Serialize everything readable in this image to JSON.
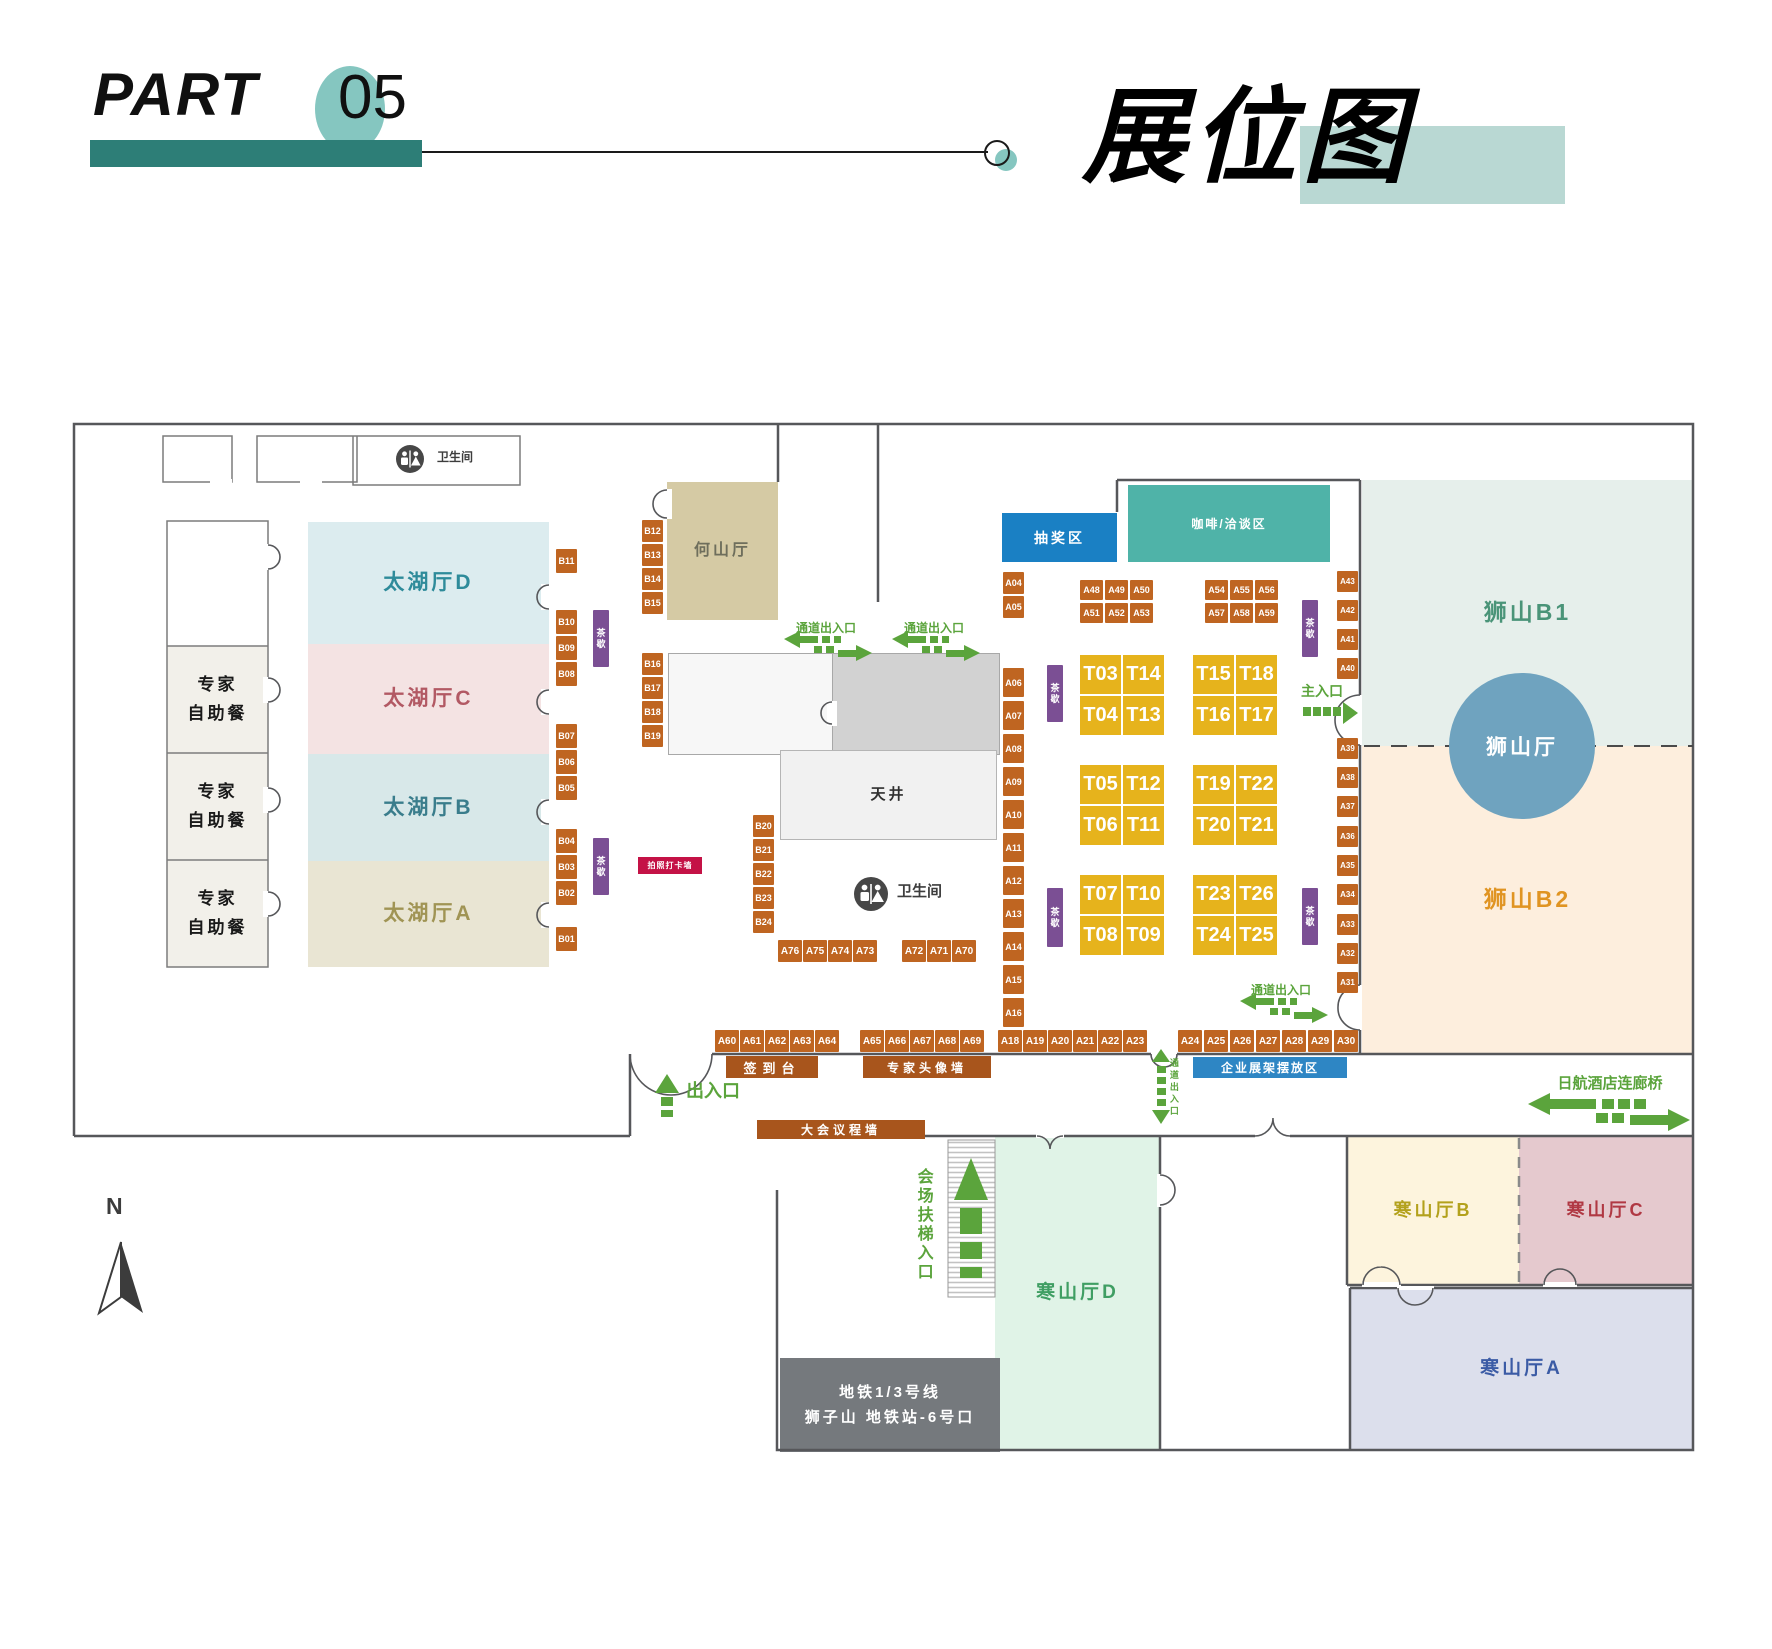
{
  "header": {
    "part": "PART",
    "number": "05",
    "title": "展位图"
  },
  "plan": {
    "tea_label": "茶歇",
    "rooms": [
      {
        "name": "room-top-1",
        "x": 163,
        "y": 436,
        "w": 69,
        "h": 46,
        "bg": "#ffffff"
      },
      {
        "name": "room-top-2",
        "x": 257,
        "y": 436,
        "w": 100,
        "h": 46,
        "bg": "#ffffff"
      },
      {
        "name": "room-restroom-top",
        "x": 353,
        "y": 436,
        "w": 167,
        "h": 49,
        "bg": "#ffffff"
      },
      {
        "name": "room-empty-left",
        "x": 167,
        "y": 521,
        "w": 101,
        "h": 125,
        "bg": "#ffffff"
      },
      {
        "name": "buffet-room-1",
        "x": 167,
        "y": 646,
        "w": 101,
        "h": 107,
        "bg": "#f2f0ea",
        "label": "专家",
        "label2": "自助餐",
        "fg": "#1a1a1a",
        "fs": 17
      },
      {
        "name": "buffet-room-2",
        "x": 167,
        "y": 753,
        "w": 101,
        "h": 107,
        "bg": "#f2f0ea",
        "label": "专家",
        "label2": "自助餐",
        "fg": "#1a1a1a",
        "fs": 17
      },
      {
        "name": "buffet-room-3",
        "x": 167,
        "y": 860,
        "w": 101,
        "h": 107,
        "bg": "#f2f0ea",
        "label": "专家",
        "label2": "自助餐",
        "fg": "#1a1a1a",
        "fs": 17
      },
      {
        "name": "hall-taihu-d",
        "x": 308,
        "y": 522,
        "w": 241,
        "h": 122,
        "bg": "#dcecef",
        "label": "太湖厅D",
        "fg": "#2e8b9a",
        "fs": 21
      },
      {
        "name": "hall-taihu-c",
        "x": 308,
        "y": 644,
        "w": 241,
        "h": 110,
        "bg": "#f4e3e3",
        "label": "太湖厅C",
        "fg": "#b25964",
        "fs": 21
      },
      {
        "name": "hall-taihu-b",
        "x": 308,
        "y": 754,
        "w": 241,
        "h": 107,
        "bg": "#d8e8e9",
        "label": "太湖厅B",
        "fg": "#3a7d8c",
        "fs": 21
      },
      {
        "name": "hall-taihu-a",
        "x": 308,
        "y": 861,
        "w": 241,
        "h": 106,
        "bg": "#e9e5d3",
        "label": "太湖厅A",
        "fg": "#a09454",
        "fs": 21
      },
      {
        "name": "hall-heshan",
        "x": 667,
        "y": 482,
        "w": 111,
        "h": 138,
        "bg": "#d5caa4",
        "label": "何山厅",
        "fg": "#6e6e5c",
        "fs": 16
      },
      {
        "name": "room-center-light",
        "x": 668,
        "y": 653,
        "w": 164,
        "h": 100,
        "bg": "#f7f7f7",
        "bd": "#a8a8a8"
      },
      {
        "name": "room-center-gray",
        "x": 832,
        "y": 653,
        "w": 166,
        "h": 100,
        "bg": "#d2d2d2",
        "bd": "#a8a8a8"
      },
      {
        "name": "courtyard-tianjing",
        "x": 780,
        "y": 750,
        "w": 215,
        "h": 88,
        "bg": "#f1f1f1",
        "bd": "#b5b5b5",
        "label": "天井",
        "fg": "#2f2f2f",
        "fs": 15
      },
      {
        "name": "hall-shishan-b1",
        "x": 1362,
        "y": 480,
        "w": 331,
        "h": 266,
        "bg": "#e6efeb",
        "label": "狮山B1",
        "fg": "#4a9478",
        "fs": 23
      },
      {
        "name": "hall-shishan-b2",
        "x": 1362,
        "y": 746,
        "w": 331,
        "h": 308,
        "bg": "#fdeedd",
        "label": "狮山B2",
        "fg": "#e09422",
        "fs": 23
      },
      {
        "name": "hall-hanshan-d",
        "x": 995,
        "y": 1136,
        "w": 165,
        "h": 314,
        "bg": "#e0f3e7",
        "label": "寒山厅D",
        "fg": "#3f9e63",
        "fs": 19
      },
      {
        "name": "hall-hanshan-b",
        "x": 1347,
        "y": 1136,
        "w": 172,
        "h": 149,
        "bg": "#fdf4dd",
        "label": "寒山厅B",
        "fg": "#b3a11c",
        "fs": 18
      },
      {
        "name": "hall-hanshan-c",
        "x": 1519,
        "y": 1136,
        "w": 174,
        "h": 149,
        "bg": "#e5c9ce",
        "label": "寒山厅C",
        "fg": "#b03843",
        "fs": 18
      },
      {
        "name": "hall-hanshan-a",
        "x": 1350,
        "y": 1288,
        "w": 343,
        "h": 162,
        "bg": "#dcdfec",
        "label": "寒山厅A",
        "fg": "#3b5ba5",
        "fs": 19
      },
      {
        "name": "metro-block",
        "x": 780,
        "y": 1358,
        "w": 220,
        "h": 94,
        "bg": "#75797d",
        "label": "地铁1/3号线",
        "label2": "狮子山 地铁站-6号口",
        "fg": "#ffffff",
        "fs": 15
      }
    ],
    "circle": {
      "name": "hall-shishan-ting",
      "x": 1449,
      "y": 673,
      "d": 146,
      "bg": "#6fa3bf",
      "label": "狮山厅",
      "fg": "#ffffff",
      "fs": 21
    },
    "zones": [
      {
        "name": "zone-lottery",
        "label": "抽奖区",
        "x": 1002,
        "y": 513,
        "w": 115,
        "h": 49,
        "bg": "#1a80c4",
        "fs": 14,
        "ls": 3
      },
      {
        "name": "zone-coffee",
        "label": "咖啡/洽谈区",
        "x": 1128,
        "y": 485,
        "w": 202,
        "h": 77,
        "bg": "#4fb3a8",
        "fs": 12,
        "ls": 2
      },
      {
        "name": "bar-signin",
        "label": "签到台",
        "x": 726,
        "y": 1056,
        "w": 92,
        "h": 22,
        "bg": "#a8551c",
        "fs": 13,
        "ls": 6
      },
      {
        "name": "bar-expert-wall",
        "label": "专家头像墙",
        "x": 863,
        "y": 1056,
        "w": 128,
        "h": 22,
        "bg": "#a8551c",
        "fs": 12,
        "ls": 4
      },
      {
        "name": "bar-display-rack",
        "label": "企业展架摆放区",
        "x": 1193,
        "y": 1057,
        "w": 154,
        "h": 21,
        "bg": "#2e86c4",
        "fs": 12,
        "ls": 2
      },
      {
        "name": "bar-agenda-wall",
        "label": "大会议程墙",
        "x": 757,
        "y": 1120,
        "w": 168,
        "h": 19,
        "bg": "#a8551c",
        "fs": 12,
        "ls": 4
      },
      {
        "name": "tag-photo-wall",
        "label": "拍照打卡墙",
        "x": 638,
        "y": 857,
        "w": 64,
        "h": 17,
        "bg": "#c41246",
        "fs": 8,
        "ls": 1
      }
    ],
    "tea_tags": [
      {
        "x": 593,
        "y": 610,
        "h": 57
      },
      {
        "x": 593,
        "y": 838,
        "h": 57
      },
      {
        "x": 1047,
        "y": 665,
        "h": 57
      },
      {
        "x": 1047,
        "y": 888,
        "h": 59
      },
      {
        "x": 1302,
        "y": 600,
        "h": 57
      },
      {
        "x": 1302,
        "y": 888,
        "h": 57
      }
    ],
    "booth_cols": [
      {
        "x": 556,
        "w": 21,
        "h": 24,
        "fs": 9,
        "items": [
          [
            "B11",
            549
          ],
          [
            "B10",
            610
          ],
          [
            "B09",
            636
          ],
          [
            "B08",
            662
          ],
          [
            "B07",
            724
          ],
          [
            "B06",
            750
          ],
          [
            "B05",
            776
          ],
          [
            "B04",
            829
          ],
          [
            "B03",
            855
          ],
          [
            "B02",
            881
          ],
          [
            "B01",
            927
          ]
        ]
      },
      {
        "x": 642,
        "w": 21,
        "h": 22,
        "fs": 9,
        "items": [
          [
            "B12",
            520
          ],
          [
            "B13",
            544
          ],
          [
            "B14",
            568
          ],
          [
            "B15",
            592
          ],
          [
            "B16",
            653
          ],
          [
            "B17",
            677
          ],
          [
            "B18",
            701
          ],
          [
            "B19",
            725
          ]
        ]
      },
      {
        "x": 753,
        "w": 21,
        "h": 22,
        "fs": 9,
        "items": [
          [
            "B20",
            815
          ],
          [
            "B21",
            839
          ],
          [
            "B22",
            863
          ],
          [
            "B23",
            887
          ],
          [
            "B24",
            911
          ]
        ]
      },
      {
        "x": 1003,
        "w": 21,
        "h": 22,
        "fs": 9,
        "items": [
          [
            "A04",
            572
          ],
          [
            "A05",
            596
          ]
        ]
      },
      {
        "x": 1003,
        "w": 21,
        "h": 29,
        "fs": 9,
        "items": [
          [
            "A06",
            668
          ],
          [
            "A07",
            701
          ],
          [
            "A08",
            734
          ],
          [
            "A09",
            767
          ],
          [
            "A10",
            800
          ],
          [
            "A11",
            833
          ],
          [
            "A12",
            866
          ],
          [
            "A13",
            899
          ],
          [
            "A14",
            932
          ],
          [
            "A15",
            965
          ],
          [
            "A16",
            998
          ]
        ]
      },
      {
        "x": 1337,
        "w": 21,
        "h": 21,
        "fs": 8,
        "items": [
          [
            "A43",
            571
          ],
          [
            "A42",
            600
          ],
          [
            "A41",
            629
          ],
          [
            "A40",
            658
          ],
          [
            "A39",
            738
          ],
          [
            "A38",
            767
          ],
          [
            "A37",
            796
          ],
          [
            "A36",
            826
          ],
          [
            "A35",
            855
          ],
          [
            "A34",
            884
          ],
          [
            "A33",
            914
          ],
          [
            "A32",
            943
          ],
          [
            "A31",
            972
          ]
        ]
      }
    ],
    "booth_rows": [
      {
        "y": 580,
        "w": 23,
        "h": 20,
        "fs": 9,
        "items": [
          [
            "A48",
            1080
          ],
          [
            "A49",
            1105
          ],
          [
            "A50",
            1130
          ],
          [
            "A54",
            1205
          ],
          [
            "A55",
            1230
          ],
          [
            "A56",
            1255
          ]
        ]
      },
      {
        "y": 603,
        "w": 23,
        "h": 20,
        "fs": 9,
        "items": [
          [
            "A51",
            1080
          ],
          [
            "A52",
            1105
          ],
          [
            "A53",
            1130
          ],
          [
            "A57",
            1205
          ],
          [
            "A58",
            1230
          ],
          [
            "A59",
            1255
          ]
        ]
      },
      {
        "y": 940,
        "w": 24,
        "h": 22,
        "fs": 10,
        "items": [
          [
            "A76",
            778
          ],
          [
            "A75",
            803
          ],
          [
            "A74",
            828
          ],
          [
            "A73",
            853
          ],
          [
            "A72",
            902
          ],
          [
            "A71",
            927
          ],
          [
            "A70",
            952
          ]
        ]
      },
      {
        "y": 1030,
        "w": 24,
        "h": 22,
        "fs": 10,
        "items": [
          [
            "A60",
            715
          ],
          [
            "A61",
            740
          ],
          [
            "A62",
            765
          ],
          [
            "A63",
            790
          ],
          [
            "A64",
            815
          ],
          [
            "A65",
            860
          ],
          [
            "A66",
            885
          ],
          [
            "A67",
            910
          ],
          [
            "A68",
            935
          ],
          [
            "A69",
            960
          ],
          [
            "A18",
            998
          ],
          [
            "A19",
            1023
          ],
          [
            "A20",
            1048
          ],
          [
            "A21",
            1073
          ],
          [
            "A22",
            1098
          ],
          [
            "A23",
            1123
          ],
          [
            "A24",
            1178
          ],
          [
            "A25",
            1204
          ],
          [
            "A26",
            1230
          ],
          [
            "A27",
            1256
          ],
          [
            "A28",
            1282
          ],
          [
            "A29",
            1308
          ],
          [
            "A30",
            1334
          ]
        ]
      }
    ],
    "t_booths": {
      "w": 41,
      "h": 39,
      "fs": 20,
      "items": [
        [
          "T03",
          1080,
          655
        ],
        [
          "T14",
          1123,
          655
        ],
        [
          "T04",
          1080,
          696
        ],
        [
          "T13",
          1123,
          696
        ],
        [
          "T15",
          1193,
          655
        ],
        [
          "T18",
          1236,
          655
        ],
        [
          "T16",
          1193,
          696
        ],
        [
          "T17",
          1236,
          696
        ],
        [
          "T05",
          1080,
          765
        ],
        [
          "T12",
          1123,
          765
        ],
        [
          "T06",
          1080,
          806
        ],
        [
          "T11",
          1123,
          806
        ],
        [
          "T19",
          1193,
          765
        ],
        [
          "T22",
          1236,
          765
        ],
        [
          "T20",
          1193,
          806
        ],
        [
          "T21",
          1236,
          806
        ],
        [
          "T07",
          1080,
          875
        ],
        [
          "T10",
          1123,
          875
        ],
        [
          "T08",
          1080,
          916
        ],
        [
          "T09",
          1123,
          916
        ],
        [
          "T23",
          1193,
          875
        ],
        [
          "T26",
          1236,
          875
        ],
        [
          "T24",
          1193,
          916
        ],
        [
          "T25",
          1236,
          916
        ]
      ]
    },
    "labels": [
      {
        "name": "passage-entrance-label",
        "t": "通道出入口",
        "x": 826,
        "y": 622,
        "fs": 12,
        "color": "#5ba43c",
        "center": 1
      },
      {
        "name": "passage-entrance-label",
        "t": "通道出入口",
        "x": 934,
        "y": 622,
        "fs": 12,
        "color": "#5ba43c",
        "center": 1
      },
      {
        "name": "passage-entrance-label",
        "t": "通道出入口",
        "x": 1281,
        "y": 984,
        "fs": 12,
        "color": "#5ba43c",
        "center": 1
      },
      {
        "name": "passage-entrance-label-vertical",
        "t": "通道出入口",
        "x": 1168,
        "y": 1058,
        "fs": 9,
        "color": "#5ba43c",
        "vert": 1
      },
      {
        "name": "main-entrance-label",
        "t": "主入口",
        "x": 1322,
        "y": 684,
        "fs": 14,
        "color": "#5ba43c",
        "center": 1
      },
      {
        "name": "exit-label",
        "t": "出入口",
        "x": 686,
        "y": 1082,
        "fs": 18,
        "color": "#5ba43c"
      },
      {
        "name": "escalator-entrance-label",
        "t": "会场扶梯入口",
        "x": 914,
        "y": 1168,
        "fs": 16,
        "color": "#5ba43c",
        "vert": 1
      },
      {
        "name": "hotel-bridge-label",
        "t": "日航酒店连廊桥",
        "x": 1610,
        "y": 1076,
        "fs": 15,
        "color": "#5ba43c",
        "center": 1
      },
      {
        "name": "restroom-label",
        "t": "卫生间",
        "x": 437,
        "y": 451,
        "fs": 12,
        "color": "#3d3d3d"
      },
      {
        "name": "restroom-label",
        "t": "卫生间",
        "x": 897,
        "y": 884,
        "fs": 15,
        "color": "#3d3d3d"
      },
      {
        "name": "compass-label",
        "t": "N",
        "x": 106,
        "y": 1194,
        "fs": 23,
        "color": "#3c3c3c"
      }
    ]
  }
}
